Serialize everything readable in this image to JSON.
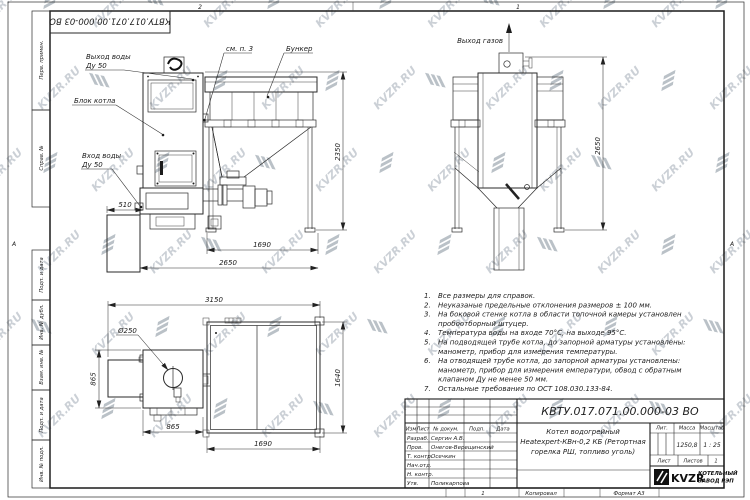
{
  "watermark": {
    "text": "KVZR.RU"
  },
  "frame": {
    "top_doc_number": "КВТУ.017.071.00.000-03 ВО",
    "zone_top_left": "2",
    "zone_top_right": "1",
    "zone_side": "А",
    "zone_bottom": "1",
    "copied": "Копировал",
    "format": "Формат А3",
    "margin_fields": [
      "Перв. примен.",
      "Справ. №",
      "Подп. и дата",
      "Инв. № дубл.",
      "Взам. инв. №",
      "Подп. и дата",
      "Инв. № подл."
    ]
  },
  "front": {
    "out_water": "Выход воды",
    "out_water_dn": "Ду 50",
    "block": "Блок котла",
    "in_water": "Вход воды",
    "in_water_dn": "Ду 50",
    "see_note": "см. п. 3",
    "bunker": "Бункер",
    "d510": "510",
    "d1690": "1690",
    "d2650": "2650",
    "d2350": "2350"
  },
  "side": {
    "gas_out": "Выход газов",
    "d2650": "2650"
  },
  "top": {
    "d250": "Ø250",
    "d3150": "3150",
    "d865_left": "865",
    "d865_bottom": "865",
    "d1640": "1640",
    "d1690": "1690"
  },
  "notes": [
    {
      "num": "1.",
      "lines": [
        "Все размеры для справок."
      ]
    },
    {
      "num": "2.",
      "lines": [
        "Неуказаные предельные отклонения размеров ± 100 мм."
      ]
    },
    {
      "num": "3.",
      "lines": [
        "На боковой стенке котла в области топочной камеры установлен",
        "пробоотборный штуцер."
      ]
    },
    {
      "num": "4.",
      "lines": [
        "Температура воды на входе 70°С, на выходе 95°С."
      ]
    },
    {
      "num": "5.",
      "lines": [
        "На подводящей трубе котла, до запорной арматуры установлены:",
        "манометр, прибор для измерения температуры."
      ]
    },
    {
      "num": "6.",
      "lines": [
        "На отводящей трубе котла, до запорной арматуры установлены:",
        "манометр, прибор для измерения емператури, обвод с обратным",
        "клапаном Ду не менее 50 мм."
      ]
    },
    {
      "num": "7.",
      "lines": [
        "Остальные требования по ОСТ 108.030.133-84."
      ]
    }
  ],
  "title_block": {
    "doc_number": "КВТУ.017.071.00.000-03 ВО",
    "product_line1": "Котел водогрейный",
    "product_line2": "Heatexpert-КВн-0,2 КБ (Ретортная",
    "product_line3": "горелка РШ, топливо уголь)",
    "col_izm": "Изм",
    "col_list": "Лист",
    "col_doc": "№ докум.",
    "col_podp": "Подп.",
    "col_data": "Дата",
    "rows": [
      {
        "role": "Разраб.",
        "name": "Сергин А.В."
      },
      {
        "role": "Пров.",
        "name": "Онегов-Верещинский"
      },
      {
        "role": "Т. контр.",
        "name": "Осечкин"
      },
      {
        "role": "Нач.отд.",
        "name": ""
      },
      {
        "role": "Н. контр.",
        "name": ""
      },
      {
        "role": "Утв.",
        "name": "Поликарпова"
      }
    ],
    "lit_label": "Лит.",
    "mass_label": "Масса",
    "scale_label": "Масштаб",
    "mass_value": "1250,8",
    "scale_value": "1 : 25",
    "sheet_label": "Лист",
    "sheets_label": "Листов",
    "sheets_value": "1",
    "logo_text": "KVZR",
    "factory_line1": "КОТЕЛЬНЫЙ",
    "factory_line2": "ЗАВОД РЭП"
  }
}
